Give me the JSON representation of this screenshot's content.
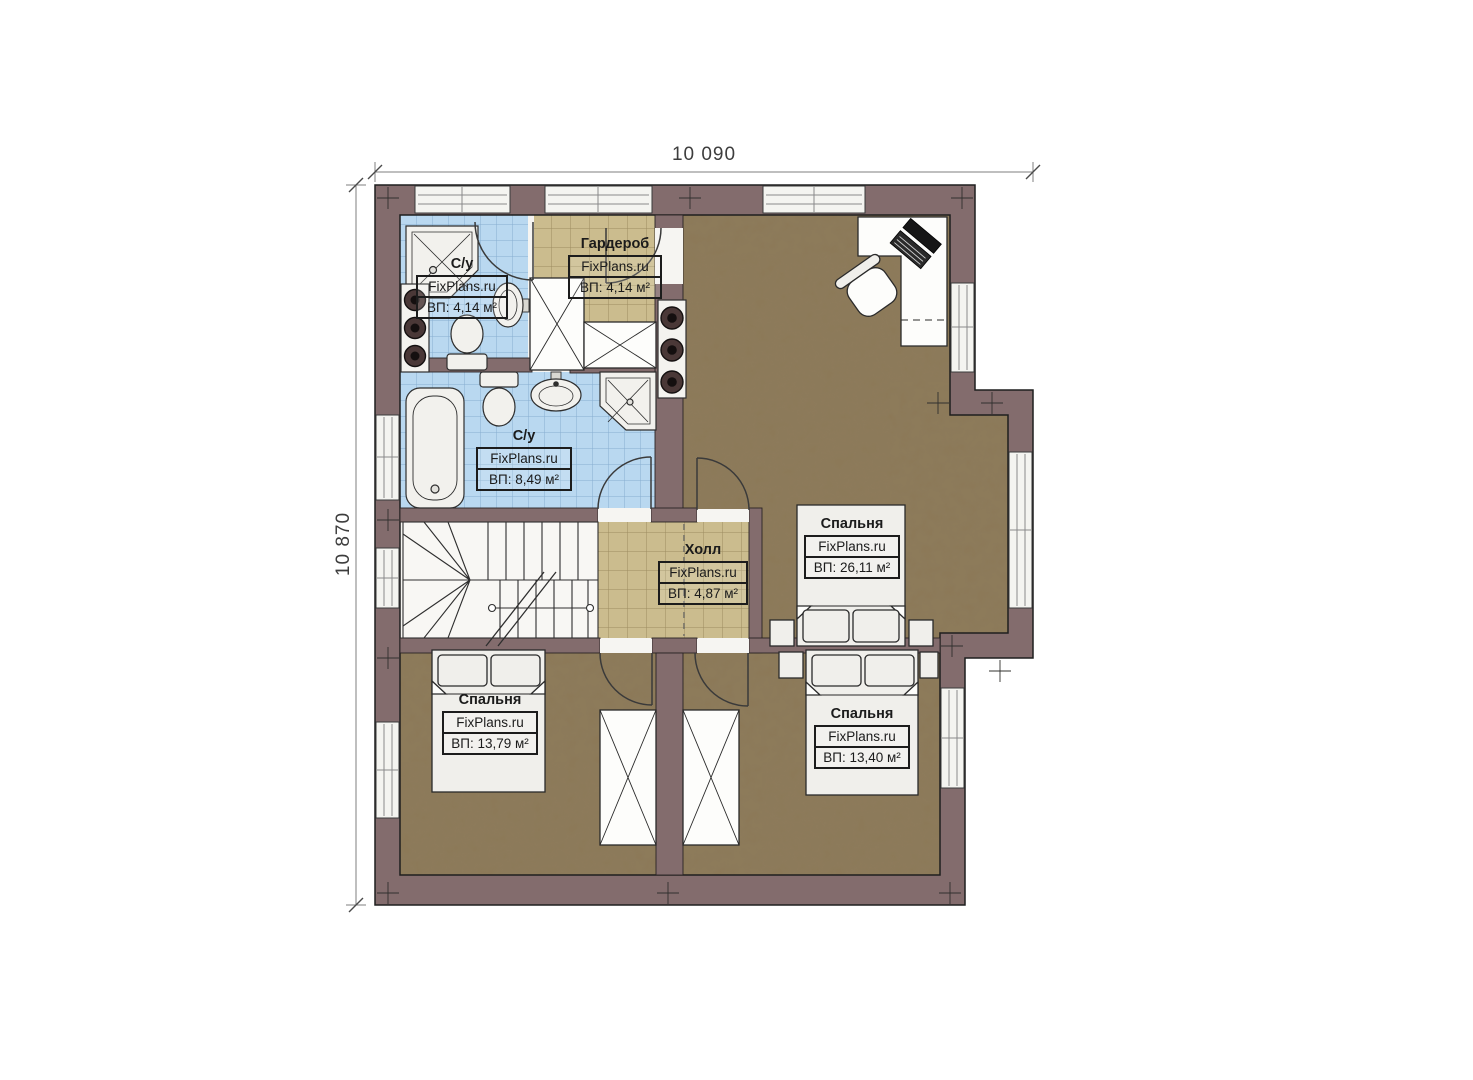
{
  "dimensions": {
    "width": "10 090",
    "height": "10 870"
  },
  "rooms": [
    {
      "name": "С/у",
      "brand": "FixPlans.ru",
      "area": "ВП: 4,14 м²"
    },
    {
      "name": "Гардероб",
      "brand": "FixPlans.ru",
      "area": "ВП: 4,14 м²"
    },
    {
      "name": "С/у",
      "brand": "FixPlans.ru",
      "area": "ВП: 8,49 м²"
    },
    {
      "name": "Холл",
      "brand": "FixPlans.ru",
      "area": "ВП: 4,87 м²"
    },
    {
      "name": "Спальня",
      "brand": "FixPlans.ru",
      "area": "ВП: 26,11 м²"
    },
    {
      "name": "Спальня",
      "brand": "FixPlans.ru",
      "area": "ВП: 13,79 м²"
    },
    {
      "name": "Спальня",
      "brand": "FixPlans.ru",
      "area": "ВП: 13,40 м²"
    }
  ],
  "colors": {
    "wall": "#836c6d",
    "bathroom_tile": "#b9d8f0",
    "tile_grid": "#86aed1",
    "hall_tile": "#cbbc8e",
    "wood_floor": "#8c7856",
    "outline": "#1e1e1e"
  }
}
